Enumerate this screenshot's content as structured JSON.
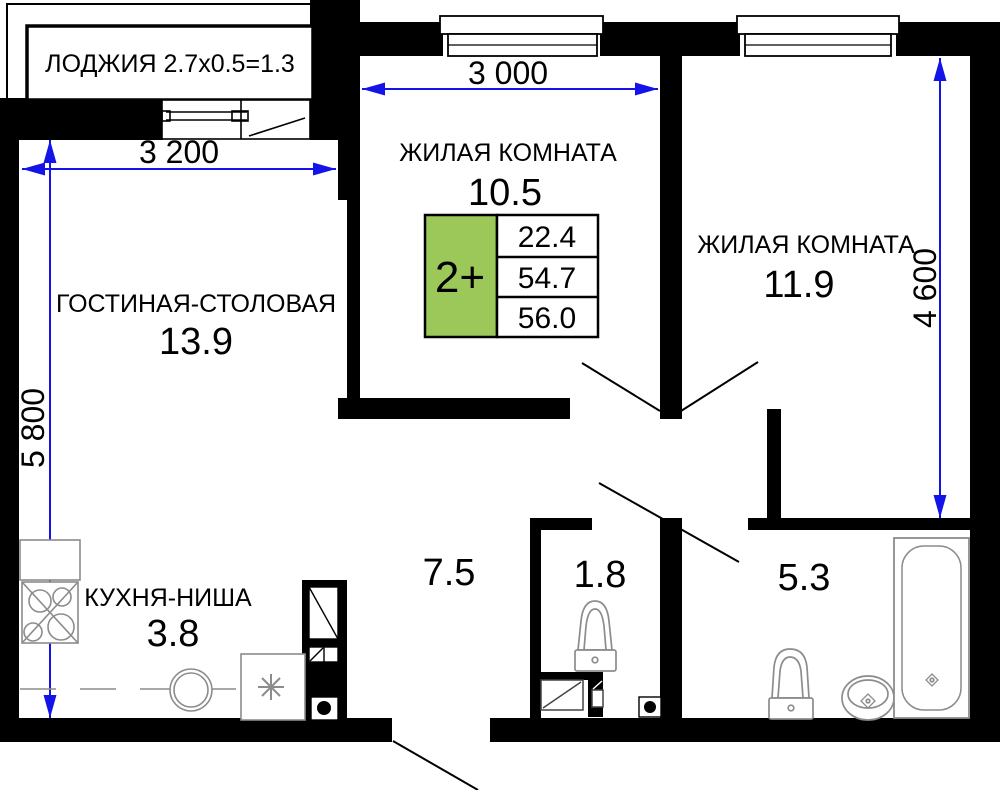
{
  "plan": {
    "loggia_label": "ЛОДЖИЯ 2.7x0.5=1.3",
    "rooms": {
      "living_room_top": {
        "name": "ЖИЛАЯ КОМНАТА",
        "area": "10.5"
      },
      "living_room_right": {
        "name": "ЖИЛАЯ КОМНАТА",
        "area": "11.9"
      },
      "living_dining": {
        "name": "ГОСТИНАЯ-СТОЛОВАЯ",
        "area": "13.9"
      },
      "kitchen_niche": {
        "name": "КУХНЯ-НИША",
        "area": "3.8"
      },
      "hallway": {
        "area": "7.5"
      },
      "wc": {
        "area": "1.8"
      },
      "bathroom": {
        "area": "5.3"
      }
    },
    "dimensions": {
      "living_dining_width": "3 200",
      "living_room_top_width": "3 000",
      "living_dining_height": "5 800",
      "living_room_right_height": "4 600"
    },
    "info_box": {
      "label": "2+",
      "values": [
        "22.4",
        "54.7",
        "56.0"
      ]
    },
    "colors": {
      "walls": "#000000",
      "dimensions": "#1414e8",
      "info_accent": "#9cc85a",
      "fixtures": "#8c8c8c"
    }
  }
}
